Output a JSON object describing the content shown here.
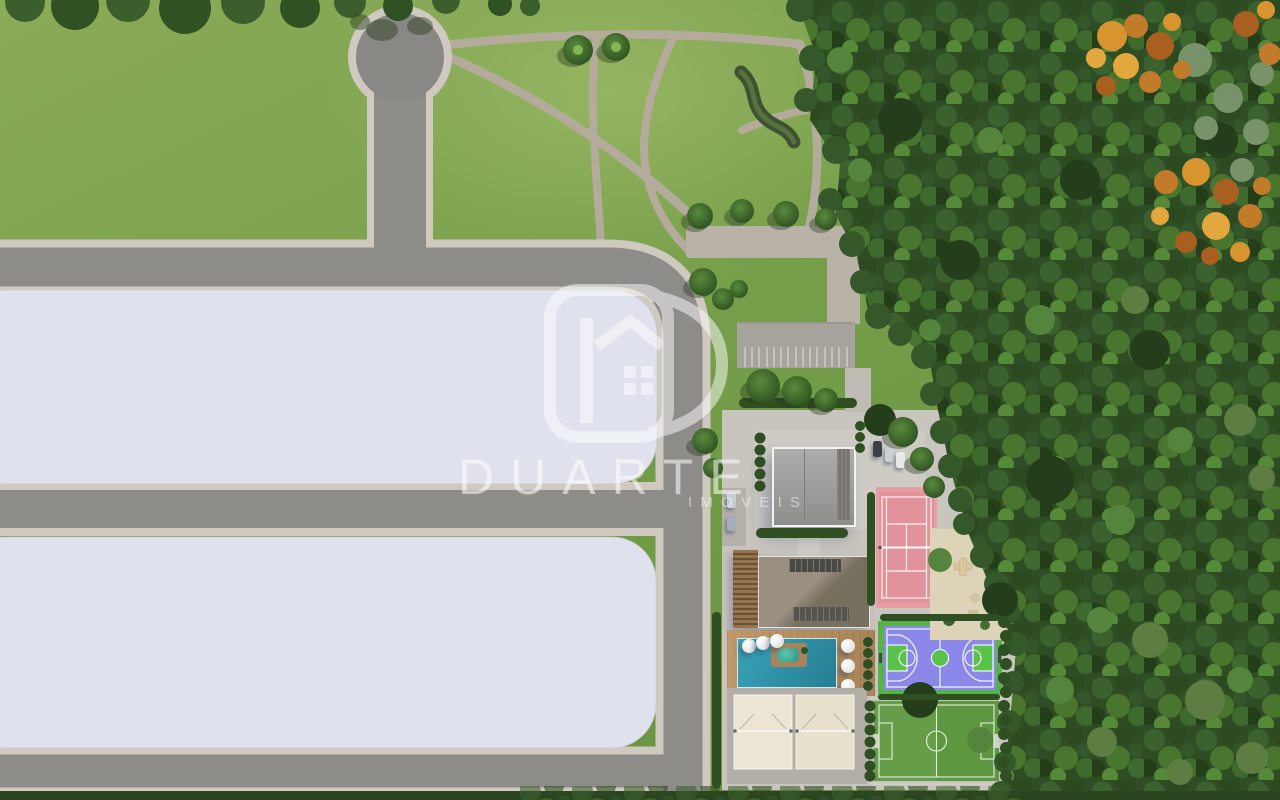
{
  "watermark": {
    "brand": "DUARTE",
    "subtitle": "IMÓVEIS"
  },
  "palette": {
    "grass": "#7aa04b",
    "forest_green": "#2e4d24",
    "autumn_orange": "#d8952f",
    "road_asphalt": "#8e8c88",
    "sidewalk": "#cfc9c0",
    "vacant_block": "#dfe2ec",
    "paving": "#c8c4be",
    "pool_water": "#2f96ac",
    "wood_deck": "#b7905f",
    "tennis_pink": "#e89da5",
    "basketball_purple": "#8b88ea",
    "sport_green": "#57b24a",
    "soccer_field": "#5d9840",
    "sand": "#ece5d3",
    "watermark_white": "#ffffff"
  }
}
